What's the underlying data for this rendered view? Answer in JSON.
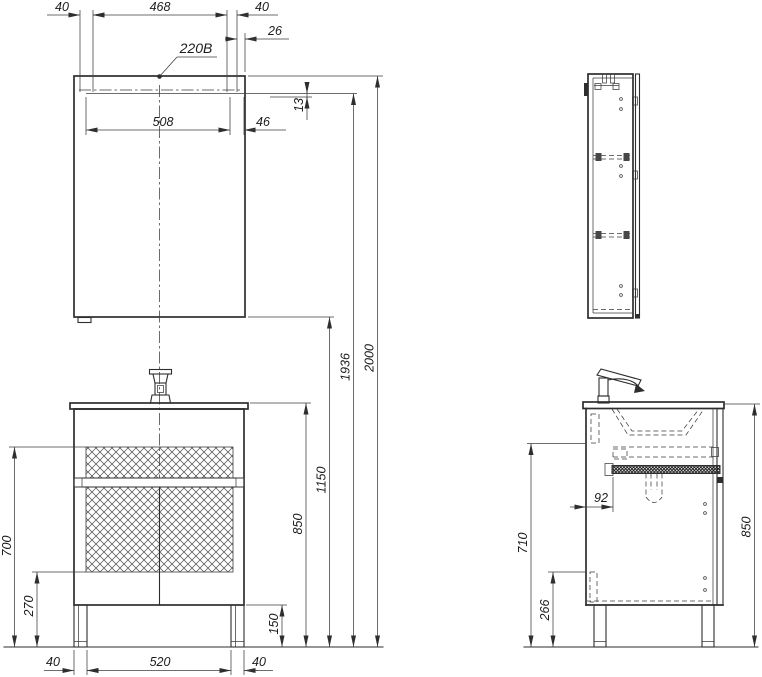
{
  "colors": {
    "line": "#2e2e2e",
    "background": "#ffffff"
  },
  "labels": {
    "mirror_top": {
      "left_offset": "40",
      "center_span": "468",
      "right_offset": "40",
      "edge_offset": "26",
      "power_outlet": "220B",
      "door_width": "508",
      "side_gap": "46",
      "panel_gap": "13"
    },
    "heights": {
      "total": "2000",
      "mounting": "1936",
      "mirror_bottom": "1150",
      "countertop": "850"
    },
    "vanity_front": {
      "basket_top": "700",
      "plinth": "270",
      "leg": "150",
      "base_left": "40",
      "base_center": "520",
      "base_right": "40"
    },
    "vanity_side": {
      "drain_offset": "92",
      "drawer_height": "710",
      "bottom_height": "266",
      "countertop": "850"
    }
  }
}
